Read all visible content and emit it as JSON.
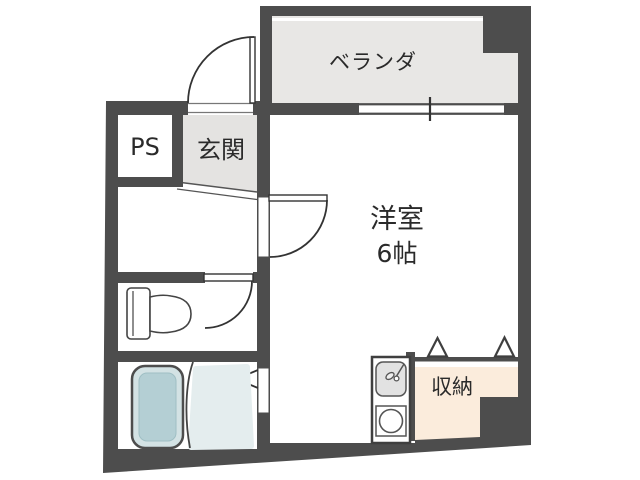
{
  "plan": {
    "title": "apartment-floor-plan",
    "labels": {
      "veranda": "ベランダ",
      "pipe_space": "PS",
      "entrance": "玄関",
      "main_room": "洋室",
      "main_room_size": "6帖",
      "storage": "収納"
    },
    "colors": {
      "wall": "#4d4d4d",
      "veranda_floor": "#e8e7e5",
      "entrance_floor": "#e4e3e1",
      "room_floor": "#ffffff",
      "storage_floor": "#fbecdc",
      "bathtub_rim": "#d3e2e4",
      "bathtub_fill": "#b4cfd4",
      "shower_floor": "#e4edee",
      "fixture_line": "#444444",
      "text": "#2a2a2a"
    }
  }
}
